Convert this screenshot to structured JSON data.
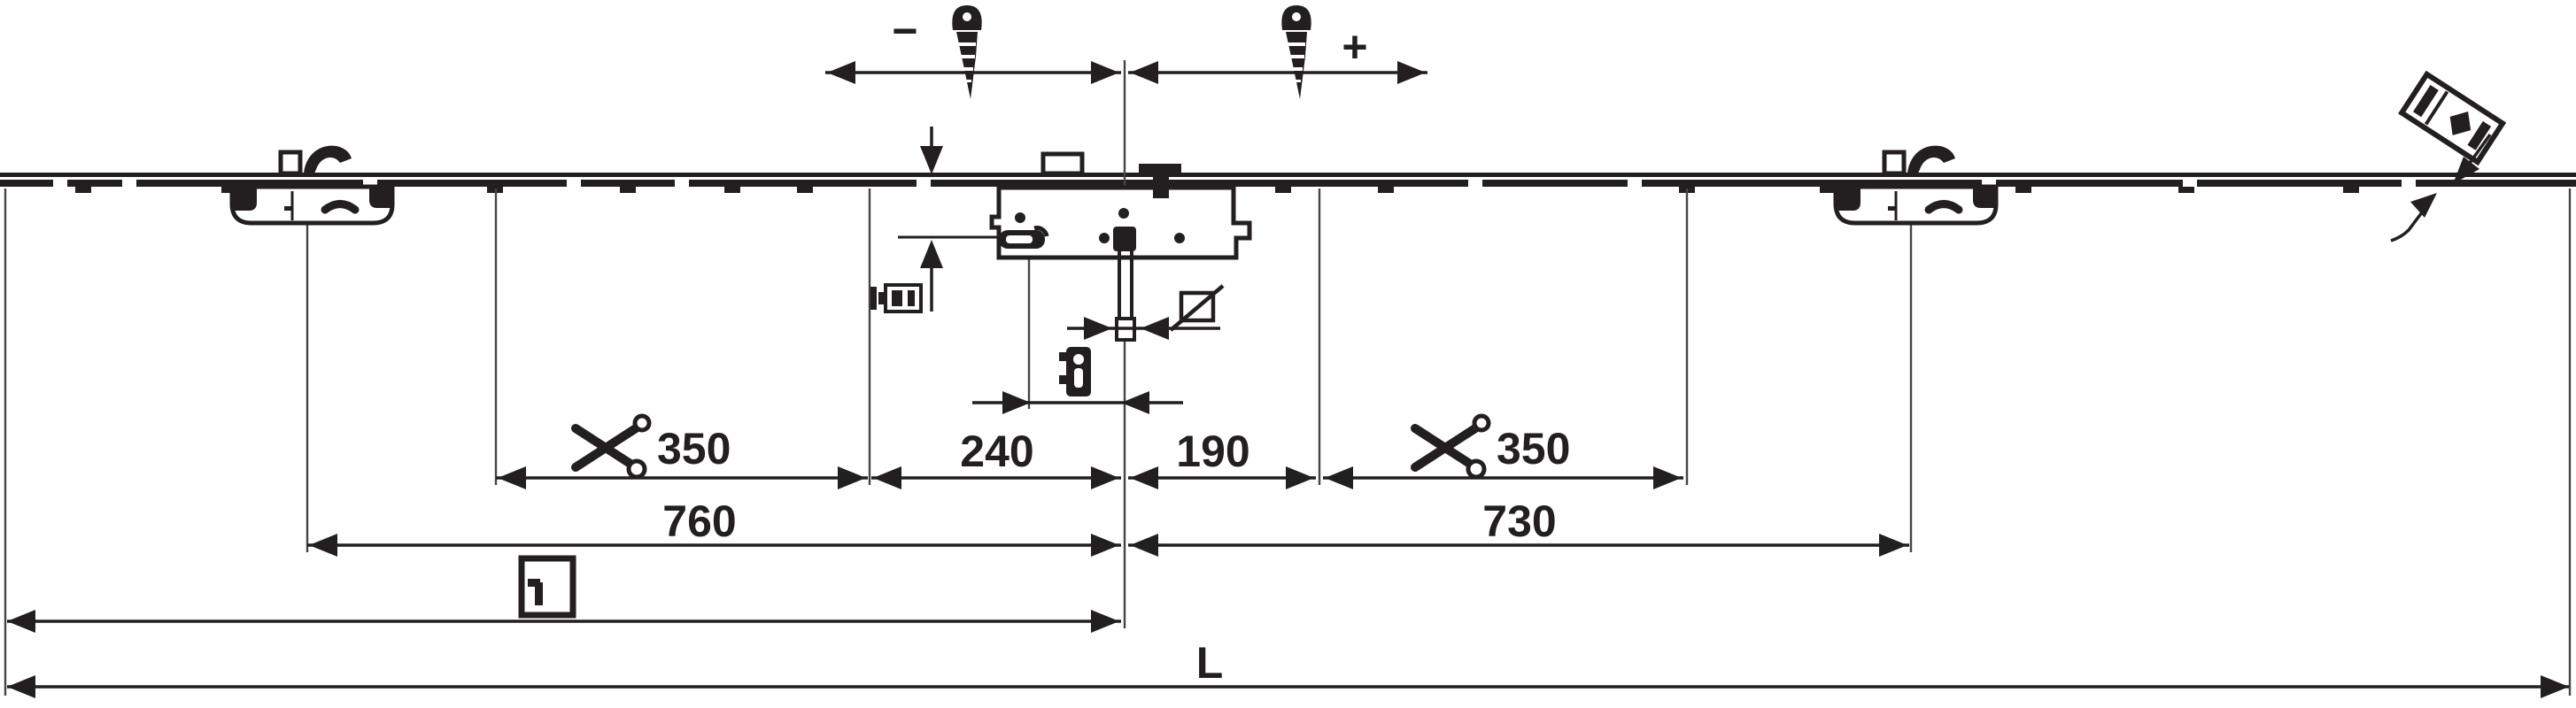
{
  "colors": {
    "ink": "#231f20",
    "background": "#ffffff"
  },
  "adjustment": {
    "minus_label": "−",
    "plus_label": "+"
  },
  "dimensions": {
    "cut_left": "350",
    "center_to_left": "240",
    "center_to_right": "190",
    "cut_right": "350",
    "left_keep_to_center": "760",
    "center_to_right_keep": "730",
    "total_length": "L"
  },
  "icons": {
    "adjustment_screw": "screw",
    "scissors": "cut-to-length-mark",
    "square_spindle": "square-with-diagonal",
    "fixing_screw": "screw-side-view",
    "profile_cylinder": "cylinder-escutcheon",
    "window_handle": "window-with-handle",
    "alignment_gauge": "tilted-gauge"
  }
}
